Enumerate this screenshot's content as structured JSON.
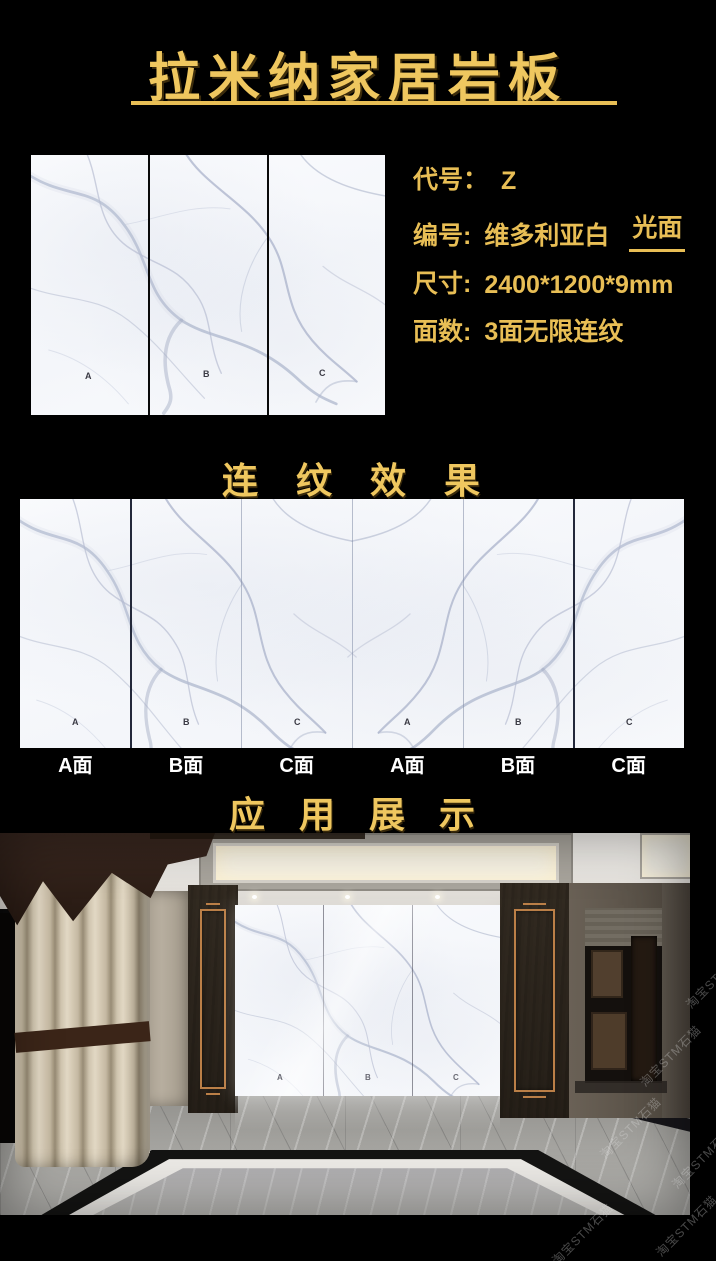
{
  "colors": {
    "gold": "#EFC75F",
    "background": "#000000"
  },
  "header": {
    "title": "拉米纳家居岩板"
  },
  "product": {
    "slab_labels": [
      "A",
      "B",
      "C"
    ],
    "specs": [
      {
        "label": "代号：",
        "value": "Z"
      },
      {
        "label": "编号:",
        "value": "维多利亚白",
        "finish": "光面"
      },
      {
        "label": "尺寸:",
        "value": "2400*1200*9mm"
      },
      {
        "label": "面数:",
        "value": "3面无限连纹"
      }
    ]
  },
  "sections": {
    "continuous_title": "连 纹 效 果",
    "application_title": "应 用 展 示"
  },
  "banner": {
    "panel_letters": [
      "A",
      "B",
      "C",
      "A",
      "B",
      "C"
    ],
    "face_labels": [
      "A面",
      "B面",
      "C面",
      "A面",
      "B面",
      "C面"
    ]
  },
  "room": {
    "wall_labels": [
      "A",
      "B",
      "C"
    ]
  },
  "watermark": {
    "text": "淘宝STM石猫"
  }
}
